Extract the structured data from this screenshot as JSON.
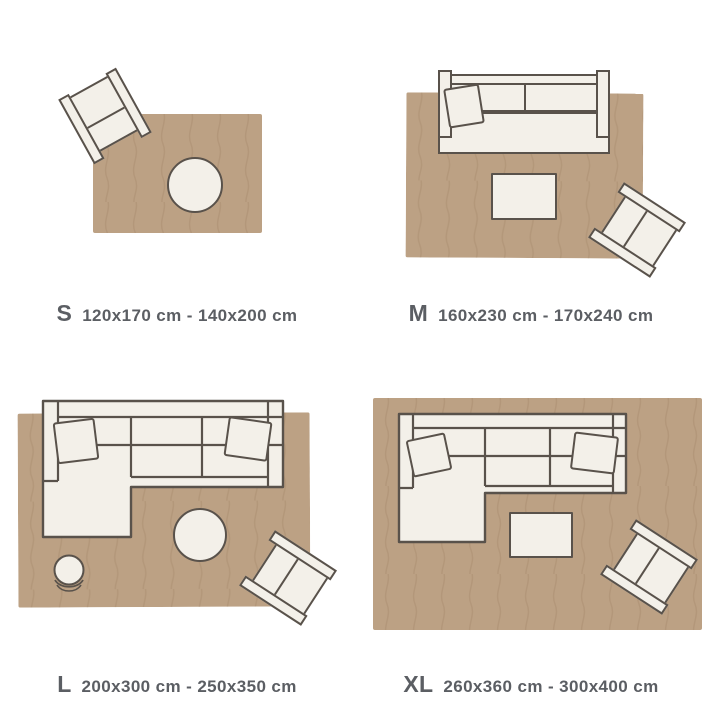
{
  "guide": {
    "sizes": [
      {
        "code": "S",
        "range": "120x170 cm - 140x200 cm",
        "furniture": [
          "armchair",
          "round-table"
        ]
      },
      {
        "code": "M",
        "range": "160x230 cm - 170x240 cm",
        "furniture": [
          "sofa",
          "pillow",
          "coffee-table",
          "armchair"
        ]
      },
      {
        "code": "L",
        "range": "200x300 cm - 250x350 cm",
        "furniture": [
          "sectional-sofa",
          "pillow",
          "pillow",
          "round-table",
          "pouf",
          "armchair"
        ]
      },
      {
        "code": "XL",
        "range": "260x360 cm - 300x400 cm",
        "furniture": [
          "sectional-sofa",
          "pillow",
          "pillow",
          "coffee-table",
          "armchair"
        ]
      }
    ]
  },
  "colors": {
    "bg": "#ffffff",
    "rug": "#bca184",
    "rug-line": "#a98e6f",
    "furniture-fill": "#f3f0e9",
    "furniture-outline": "#59524b",
    "label-text": "#5b5e63"
  }
}
